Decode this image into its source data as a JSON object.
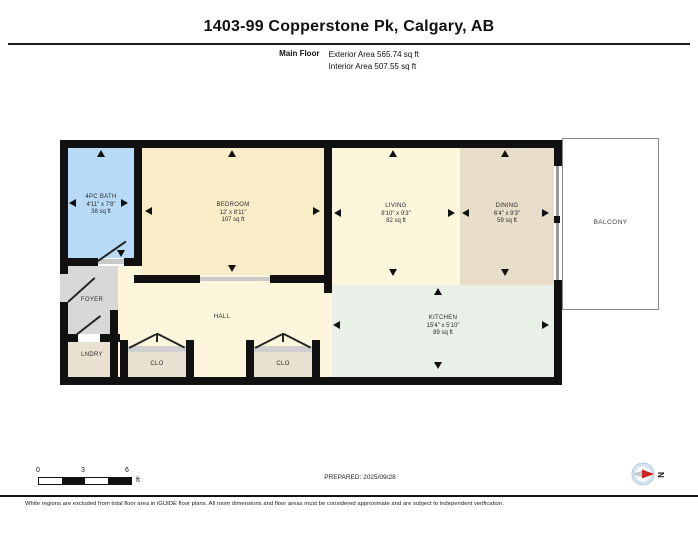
{
  "header": {
    "title": "1403-99 Copperstone Pk, Calgary, AB",
    "floor_label": "Main Floor",
    "exterior_area": "Exterior Area 565.74 sq ft",
    "interior_area": "Interior Area 507.55 sq ft"
  },
  "rooms": {
    "bath": {
      "name": "4PC BATH",
      "dims": "4'11\" x 7'8\"",
      "area": "38 sq ft"
    },
    "bedroom": {
      "name": "BEDROOM",
      "dims": "12' x 8'11\"",
      "area": "107 sq ft"
    },
    "living": {
      "name": "LIVING",
      "dims": "8'10\" x 9'3\"",
      "area": "82 sq ft"
    },
    "dining": {
      "name": "DINING",
      "dims": "6'4\" x 9'3\"",
      "area": "59 sq ft"
    },
    "kitchen": {
      "name": "KITCHEN",
      "dims": "15'4\" x 5'10\"",
      "area": "89 sq ft"
    },
    "hall": {
      "name": "HALL"
    },
    "foyer": {
      "name": "FOYER"
    },
    "laundry": {
      "name": "LNDRY"
    },
    "closet1": {
      "name": "CLO"
    },
    "closet2": {
      "name": "CLO"
    },
    "balcony": {
      "name": "BALCONY"
    }
  },
  "footer": {
    "scale": {
      "t0": "0",
      "t1": "3",
      "t2": "6",
      "unit": "ft"
    },
    "prepared": "PREPARED: 2025/09/28",
    "compass_label": "N",
    "disclaimer": "White regions are excluded from total floor area in iGUIDE floor plans. All room dimensions and floor areas must be considered approximate and are subject to independent verification."
  },
  "colors": {
    "wall": "#111111",
    "bath": "#b7dbf6",
    "bedroom": "#f9edc8",
    "living": "#fdf6dd",
    "hall": "#fdf6dd",
    "dining": "#e8ddc9",
    "kitchen": "#e9f0e8",
    "foyer": "#d8d8d8",
    "laundry_closet": "#e9e1d2",
    "closet_track": "#d0d0d0",
    "balcony_border": "#8a8a8a",
    "compass_red": "#cc2222",
    "compass_ring": "#d4e4f0"
  }
}
